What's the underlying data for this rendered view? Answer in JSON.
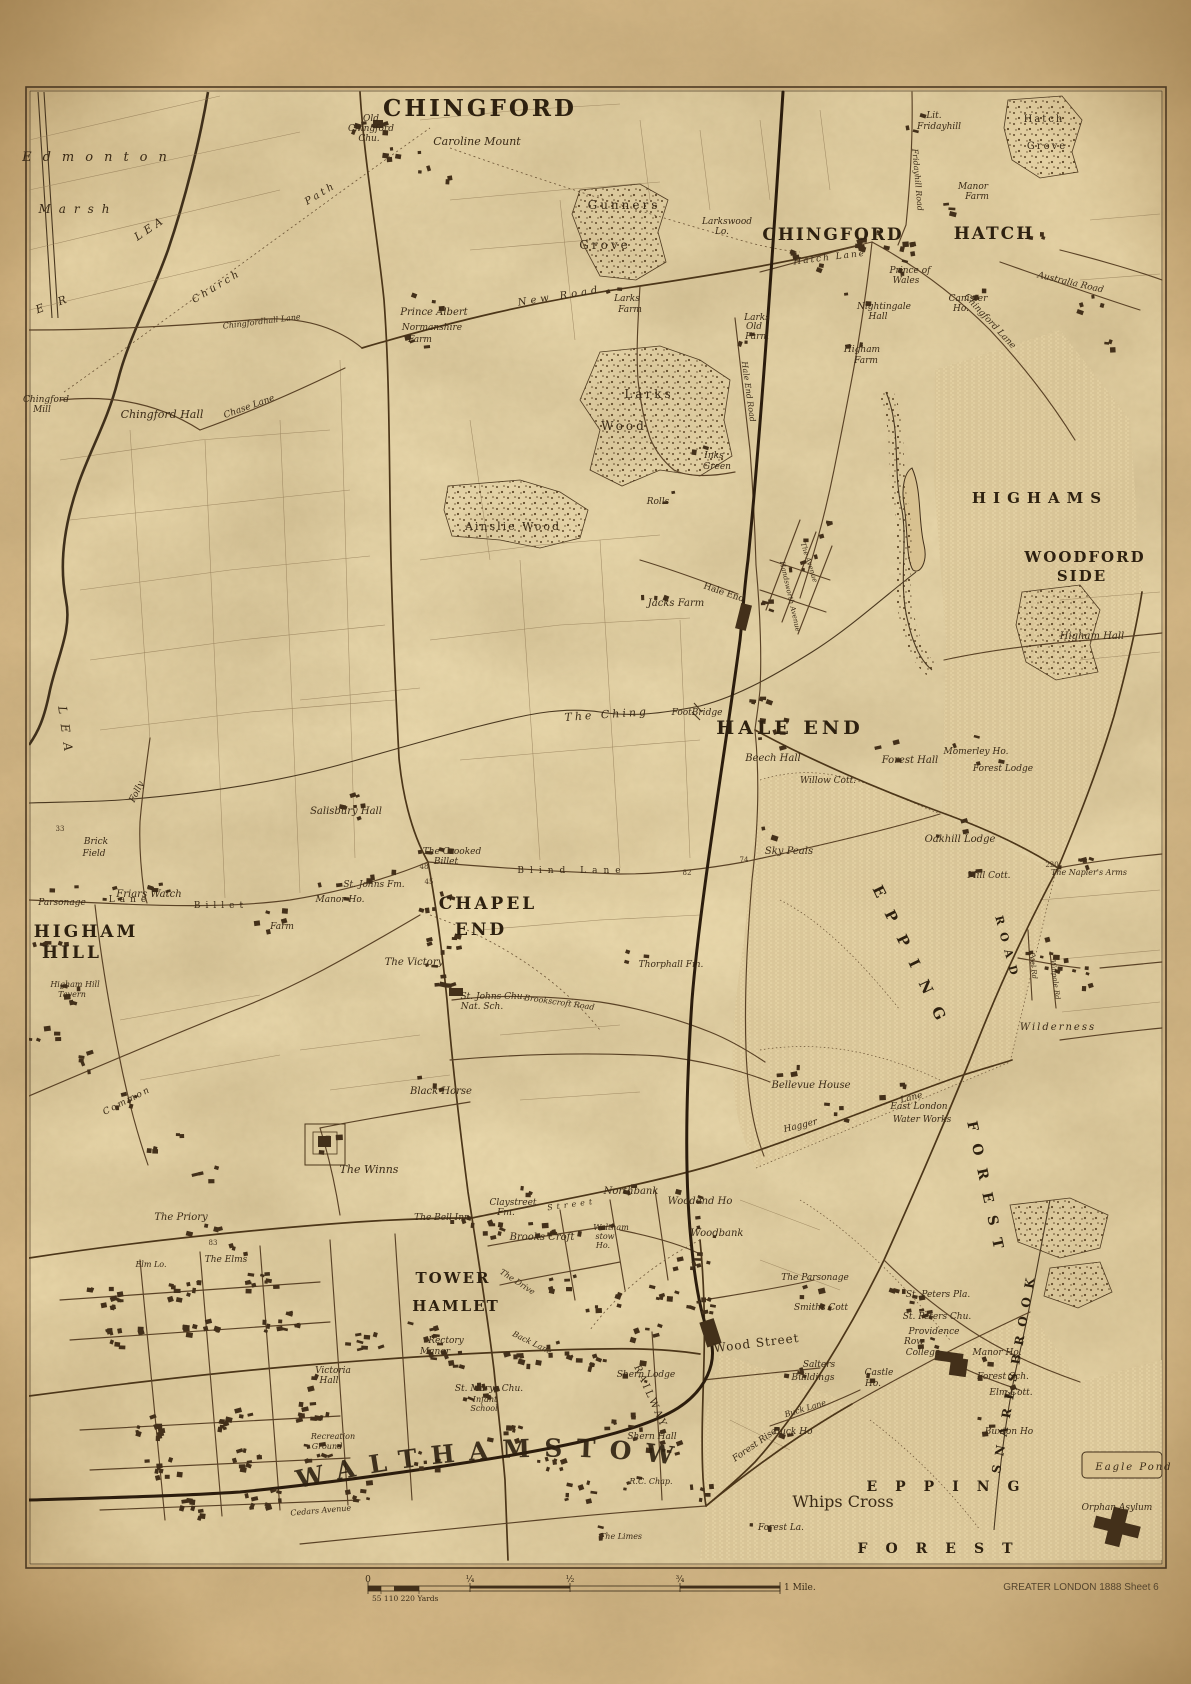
{
  "walthamstow": "WALTHAMSTOW",
  "attribution": "GREATER LONDON 1888   Sheet 6",
  "scalebar": {
    "zero": "0",
    "quarter": "¼",
    "half": "½",
    "threequarter": "¾",
    "mile": "1 Mile.",
    "yards": "55  110   220 Yards"
  },
  "labels": [
    {
      "t": "CHINGFORD",
      "x": 480,
      "y": 116,
      "s": 23,
      "cls": "d",
      "ls": 3
    },
    {
      "t": "CHINGFORD",
      "x": 833,
      "y": 240,
      "s": 17,
      "cls": "d",
      "ls": 2
    },
    {
      "t": "HATCH",
      "x": 994,
      "y": 239,
      "s": 17,
      "cls": "d",
      "ls": 2
    },
    {
      "t": "HIGHAMS",
      "x": 1040,
      "y": 503,
      "s": 15,
      "cls": "d",
      "ls": 7
    },
    {
      "t": "WOODFORD",
      "x": 1085,
      "y": 562,
      "s": 15,
      "cls": "d",
      "ls": 2
    },
    {
      "t": "SIDE",
      "x": 1082,
      "y": 581,
      "s": 15,
      "cls": "d",
      "ls": 2
    },
    {
      "t": "HALE END",
      "x": 790,
      "y": 734,
      "s": 19,
      "cls": "d",
      "ls": 4
    },
    {
      "t": "CHAPEL",
      "x": 488,
      "y": 909,
      "s": 17,
      "cls": "d",
      "ls": 3
    },
    {
      "t": "END",
      "x": 481,
      "y": 935,
      "s": 17,
      "cls": "d",
      "ls": 3
    },
    {
      "t": "HIGHAM",
      "x": 86,
      "y": 937,
      "s": 17,
      "cls": "d",
      "ls": 3
    },
    {
      "t": "HILL",
      "x": 72,
      "y": 958,
      "s": 17,
      "cls": "d",
      "ls": 3
    },
    {
      "t": "TOWER",
      "x": 453,
      "y": 1283,
      "s": 15,
      "cls": "d",
      "ls": 2
    },
    {
      "t": "HAMLET",
      "x": 456,
      "y": 1311,
      "s": 15,
      "cls": "d",
      "ls": 2
    },
    {
      "t": "EPPING",
      "x": 908,
      "y": 962,
      "s": 15,
      "cls": "d",
      "ls": 16,
      "rot": 64
    },
    {
      "t": "FOREST",
      "x": 982,
      "y": 1192,
      "s": 14,
      "cls": "d",
      "ls": 13,
      "rot": 78
    },
    {
      "t": "ROAD",
      "x": 1004,
      "y": 950,
      "s": 11,
      "cls": "d",
      "ls": 8,
      "rot": 75
    },
    {
      "t": "SNARESBROOK",
      "x": 1018,
      "y": 1372,
      "s": 12,
      "cls": "d",
      "ls": 9,
      "rot": -80
    },
    {
      "t": "EPPING",
      "x": 952,
      "y": 1491,
      "s": 14,
      "cls": "d",
      "ls": 18
    },
    {
      "t": "FOREST",
      "x": 944,
      "y": 1553,
      "s": 14,
      "cls": "d",
      "ls": 18
    },
    {
      "t": "Whips Cross",
      "x": 843,
      "y": 1507,
      "s": 16,
      "cls": "r"
    },
    {
      "t": "RAILWAY",
      "x": 648,
      "y": 1398,
      "s": 10,
      "cls": "r",
      "ls": 3,
      "rot": 66
    },
    {
      "t": "Old",
      "x": 371,
      "y": 121,
      "s": 9,
      "cls": "i"
    },
    {
      "t": "Chingford",
      "x": 371,
      "y": 131,
      "s": 9,
      "cls": "i"
    },
    {
      "t": "Chu.",
      "x": 369,
      "y": 141,
      "s": 9,
      "cls": "i"
    },
    {
      "t": "Caroline Mount",
      "x": 477,
      "y": 145,
      "s": 11,
      "cls": "i"
    },
    {
      "t": "Gunners",
      "x": 624,
      "y": 209,
      "s": 12,
      "cls": "r",
      "ls": 3
    },
    {
      "t": "Grove",
      "x": 605,
      "y": 249,
      "s": 12,
      "cls": "r",
      "ls": 3
    },
    {
      "t": "Larkswood",
      "x": 727,
      "y": 224,
      "s": 9,
      "cls": "i"
    },
    {
      "t": "Lo.",
      "x": 722,
      "y": 234,
      "s": 9,
      "cls": "i"
    },
    {
      "t": "Lit.",
      "x": 934,
      "y": 118,
      "s": 9,
      "cls": "i"
    },
    {
      "t": "Fridayhill",
      "x": 939,
      "y": 129,
      "s": 9,
      "cls": "i"
    },
    {
      "t": "Hatch",
      "x": 1044,
      "y": 122,
      "s": 10,
      "cls": "r",
      "ls": 2
    },
    {
      "t": "Grove",
      "x": 1047,
      "y": 149,
      "s": 10,
      "cls": "r",
      "ls": 2
    },
    {
      "t": "Manor",
      "x": 973,
      "y": 189,
      "s": 9,
      "cls": "i"
    },
    {
      "t": "Farm",
      "x": 977,
      "y": 199,
      "s": 9,
      "cls": "i"
    },
    {
      "t": "Prince Albert",
      "x": 434,
      "y": 315,
      "s": 10,
      "cls": "i"
    },
    {
      "t": "Normanshire",
      "x": 432,
      "y": 330,
      "s": 9,
      "cls": "i"
    },
    {
      "t": "Farm",
      "x": 420,
      "y": 342,
      "s": 9,
      "cls": "i"
    },
    {
      "t": "Larks",
      "x": 627,
      "y": 301,
      "s": 9,
      "cls": "i"
    },
    {
      "t": "Farm",
      "x": 630,
      "y": 312,
      "s": 9,
      "cls": "i"
    },
    {
      "t": "Prince of",
      "x": 910,
      "y": 273,
      "s": 9,
      "cls": "i"
    },
    {
      "t": "Wales",
      "x": 906,
      "y": 283,
      "s": 9,
      "cls": "i"
    },
    {
      "t": "Nightingale",
      "x": 884,
      "y": 309,
      "s": 9,
      "cls": "i"
    },
    {
      "t": "Hall",
      "x": 878,
      "y": 319,
      "s": 9,
      "cls": "i"
    },
    {
      "t": "Canister",
      "x": 968,
      "y": 301,
      "s": 9,
      "cls": "i"
    },
    {
      "t": "Ho.",
      "x": 961,
      "y": 311,
      "s": 9,
      "cls": "i"
    },
    {
      "t": "Larks",
      "x": 757,
      "y": 320,
      "s": 9,
      "cls": "i"
    },
    {
      "t": "Old",
      "x": 754,
      "y": 329,
      "s": 9,
      "cls": "i"
    },
    {
      "t": "Farm",
      "x": 757,
      "y": 339,
      "s": 9,
      "cls": "i"
    },
    {
      "t": "Higham",
      "x": 862,
      "y": 352,
      "s": 9,
      "cls": "i"
    },
    {
      "t": "Farm",
      "x": 866,
      "y": 363,
      "s": 9,
      "cls": "i"
    },
    {
      "t": "Chingford",
      "x": 46,
      "y": 402,
      "s": 9,
      "cls": "i"
    },
    {
      "t": "Mill",
      "x": 42,
      "y": 412,
      "s": 9,
      "cls": "i"
    },
    {
      "t": "Chingford Hall",
      "x": 162,
      "y": 418,
      "s": 11,
      "cls": "i"
    },
    {
      "t": "Chase Lane",
      "x": 250,
      "y": 409,
      "s": 9,
      "cls": "i",
      "rot": -20
    },
    {
      "t": "Church",
      "x": 218,
      "y": 289,
      "s": 10,
      "cls": "i",
      "rot": -31,
      "ls": 3
    },
    {
      "t": "Path",
      "x": 322,
      "y": 196,
      "s": 10,
      "cls": "i",
      "rot": -31,
      "ls": 3
    },
    {
      "t": "Chingfordhall Lane",
      "x": 262,
      "y": 324,
      "s": 8,
      "cls": "i",
      "rot": -7
    },
    {
      "t": "Edmonton",
      "x": 100,
      "y": 161,
      "s": 13,
      "cls": "i",
      "ls": 11
    },
    {
      "t": "Marsh",
      "x": 78,
      "y": 213,
      "s": 12,
      "cls": "i",
      "ls": 8
    },
    {
      "t": "E R",
      "x": 55,
      "y": 307,
      "s": 11,
      "cls": "i",
      "ls": 6,
      "rot": -20
    },
    {
      "t": "LEA",
      "x": 152,
      "y": 231,
      "s": 11,
      "cls": "i",
      "ls": 4,
      "rot": -34
    },
    {
      "t": "LEA",
      "x": 62,
      "y": 734,
      "s": 12,
      "cls": "i",
      "ls": 10,
      "rot": 82
    },
    {
      "t": "Larks",
      "x": 649,
      "y": 398,
      "s": 12,
      "cls": "r",
      "ls": 3
    },
    {
      "t": "Wood",
      "x": 624,
      "y": 430,
      "s": 12,
      "cls": "r",
      "ls": 3
    },
    {
      "t": "Ainslie Wood",
      "x": 513,
      "y": 530,
      "s": 11,
      "cls": "r",
      "ls": 2
    },
    {
      "t": "Inks",
      "x": 714,
      "y": 458,
      "s": 9,
      "cls": "i"
    },
    {
      "t": "Green",
      "x": 717,
      "y": 469,
      "s": 9,
      "cls": "i"
    },
    {
      "t": "Rolls",
      "x": 658,
      "y": 504,
      "s": 9,
      "cls": "i"
    },
    {
      "t": "Hale End Road",
      "x": 746,
      "y": 392,
      "s": 8,
      "cls": "i",
      "rot": 82
    },
    {
      "t": "Fridayhill Road",
      "x": 915,
      "y": 180,
      "s": 8,
      "cls": "i",
      "rot": 85
    },
    {
      "t": "Hatch Lane",
      "x": 830,
      "y": 260,
      "s": 9,
      "cls": "i",
      "rot": -7,
      "ls": 2
    },
    {
      "t": "Australia Road",
      "x": 1070,
      "y": 285,
      "s": 9,
      "cls": "i",
      "rot": 13
    },
    {
      "t": "Chingford Lane",
      "x": 988,
      "y": 323,
      "s": 9,
      "cls": "i",
      "rot": 47
    },
    {
      "t": "New Road",
      "x": 560,
      "y": 299,
      "s": 10,
      "cls": "i",
      "rot": -9,
      "ls": 4
    },
    {
      "t": "Jacks Farm",
      "x": 676,
      "y": 606,
      "s": 10,
      "cls": "i"
    },
    {
      "t": "Hale End",
      "x": 723,
      "y": 595,
      "s": 9,
      "cls": "r",
      "rot": 19
    },
    {
      "t": "The Ching",
      "x": 607,
      "y": 718,
      "s": 11,
      "cls": "i",
      "ls": 3,
      "rot": -4
    },
    {
      "t": "FootBridge",
      "x": 697,
      "y": 715,
      "s": 9,
      "cls": "i"
    },
    {
      "t": "Beech Hall",
      "x": 773,
      "y": 761,
      "s": 10,
      "cls": "i"
    },
    {
      "t": "Willow Cott.",
      "x": 828,
      "y": 783,
      "s": 9,
      "cls": "i"
    },
    {
      "t": "Forest Hall",
      "x": 910,
      "y": 763,
      "s": 10,
      "cls": "i"
    },
    {
      "t": "Momerley Ho.",
      "x": 976,
      "y": 754,
      "s": 9,
      "cls": "i"
    },
    {
      "t": "Forest Lodge",
      "x": 1003,
      "y": 771,
      "s": 9,
      "cls": "i"
    },
    {
      "t": "Higham Hall",
      "x": 1092,
      "y": 639,
      "s": 10,
      "cls": "i"
    },
    {
      "t": "Salisbury Hall",
      "x": 346,
      "y": 814,
      "s": 10,
      "cls": "i"
    },
    {
      "t": "The Crooked",
      "x": 452,
      "y": 854,
      "s": 9,
      "cls": "i"
    },
    {
      "t": "Billet",
      "x": 446,
      "y": 864,
      "s": 9,
      "cls": "i"
    },
    {
      "t": "St. Johns Fm.",
      "x": 374,
      "y": 887,
      "s": 9,
      "cls": "i"
    },
    {
      "t": "Manor Ho.",
      "x": 340,
      "y": 902,
      "s": 9,
      "cls": "i"
    },
    {
      "t": "Farm",
      "x": 282,
      "y": 929,
      "s": 9,
      "cls": "i"
    },
    {
      "t": "Brick",
      "x": 96,
      "y": 844,
      "s": 9,
      "cls": "i"
    },
    {
      "t": "Field",
      "x": 94,
      "y": 856,
      "s": 9,
      "cls": "i"
    },
    {
      "t": "Friars Watch",
      "x": 149,
      "y": 897,
      "s": 10,
      "cls": "i"
    },
    {
      "t": "Parsonage",
      "x": 62,
      "y": 905,
      "s": 9,
      "cls": "i"
    },
    {
      "t": "Billet",
      "x": 221,
      "y": 908,
      "s": 9,
      "cls": "r",
      "ls": 5
    },
    {
      "t": "Lane",
      "x": 130,
      "y": 902,
      "s": 9,
      "cls": "r",
      "ls": 5
    },
    {
      "t": "Folly",
      "x": 139,
      "y": 793,
      "s": 9,
      "cls": "i",
      "rot": -64
    },
    {
      "t": "Blind Lane",
      "x": 572,
      "y": 873,
      "s": 9,
      "cls": "r",
      "ls": 6
    },
    {
      "t": "Sky Peals",
      "x": 789,
      "y": 854,
      "s": 10,
      "cls": "i"
    },
    {
      "t": "Oakhill Lodge",
      "x": 960,
      "y": 842,
      "s": 10,
      "cls": "i"
    },
    {
      "t": "Mill Cott.",
      "x": 989,
      "y": 878,
      "s": 9,
      "cls": "i"
    },
    {
      "t": "The Napier's Arms",
      "x": 1089,
      "y": 875,
      "s": 8,
      "cls": "i"
    },
    {
      "t": "Wilderness",
      "x": 1058,
      "y": 1030,
      "s": 10,
      "cls": "i",
      "ls": 2
    },
    {
      "t": "Peel Rd",
      "x": 1031,
      "y": 966,
      "s": 7,
      "cls": "i",
      "rot": 83
    },
    {
      "t": "Walpole Rd",
      "x": 1053,
      "y": 980,
      "s": 7,
      "cls": "i",
      "rot": 83
    },
    {
      "t": "Thorphall Fm.",
      "x": 671,
      "y": 967,
      "s": 9,
      "cls": "i"
    },
    {
      "t": "The Victory",
      "x": 414,
      "y": 965,
      "s": 10,
      "cls": "i"
    },
    {
      "t": "St. Johns Chu.",
      "x": 493,
      "y": 999,
      "s": 9,
      "cls": "i"
    },
    {
      "t": "Nat. Sch.",
      "x": 482,
      "y": 1009,
      "s": 9,
      "cls": "i"
    },
    {
      "t": "Brookscroft Road",
      "x": 559,
      "y": 1005,
      "s": 8,
      "cls": "i",
      "rot": 8
    },
    {
      "t": "Black Horse",
      "x": 441,
      "y": 1094,
      "s": 10,
      "cls": "i"
    },
    {
      "t": "The Winns",
      "x": 369,
      "y": 1173,
      "s": 11,
      "cls": "i"
    },
    {
      "t": "The Priory",
      "x": 181,
      "y": 1220,
      "s": 10,
      "cls": "i"
    },
    {
      "t": "The Elms",
      "x": 226,
      "y": 1262,
      "s": 9,
      "cls": "i"
    },
    {
      "t": "Elm Lo.",
      "x": 151,
      "y": 1267,
      "s": 8,
      "cls": "i"
    },
    {
      "t": "The Bell Inn",
      "x": 442,
      "y": 1220,
      "s": 9,
      "cls": "i"
    },
    {
      "t": "Common",
      "x": 128,
      "y": 1103,
      "s": 9,
      "cls": "i",
      "rot": -27,
      "ls": 2
    },
    {
      "t": "Claystreet",
      "x": 513,
      "y": 1205,
      "s": 9,
      "cls": "i"
    },
    {
      "t": "Fm.",
      "x": 506,
      "y": 1215,
      "s": 9,
      "cls": "i"
    },
    {
      "t": "Street",
      "x": 572,
      "y": 1207,
      "s": 8,
      "cls": "i",
      "rot": -8,
      "ls": 4
    },
    {
      "t": "Brooks Croft",
      "x": 542,
      "y": 1240,
      "s": 10,
      "cls": "i"
    },
    {
      "t": "Northbank",
      "x": 631,
      "y": 1194,
      "s": 10,
      "cls": "i"
    },
    {
      "t": "Woodend Ho",
      "x": 700,
      "y": 1204,
      "s": 10,
      "cls": "i"
    },
    {
      "t": "Woodbank",
      "x": 717,
      "y": 1236,
      "s": 10,
      "cls": "i"
    },
    {
      "t": "Waltham",
      "x": 611,
      "y": 1230,
      "s": 8,
      "cls": "i"
    },
    {
      "t": "stow",
      "x": 605,
      "y": 1239,
      "s": 8,
      "cls": "i"
    },
    {
      "t": "Ho.",
      "x": 603,
      "y": 1248,
      "s": 8,
      "cls": "i"
    },
    {
      "t": "The Drive",
      "x": 516,
      "y": 1284,
      "s": 8,
      "cls": "i",
      "rot": 33
    },
    {
      "t": "Hagger",
      "x": 801,
      "y": 1128,
      "s": 9,
      "cls": "i",
      "rot": -14
    },
    {
      "t": "Lane",
      "x": 912,
      "y": 1100,
      "s": 9,
      "cls": "i",
      "rot": -14
    },
    {
      "t": "East London",
      "x": 919,
      "y": 1109,
      "s": 9,
      "cls": "i"
    },
    {
      "t": "Water Works",
      "x": 922,
      "y": 1122,
      "s": 9,
      "cls": "i"
    },
    {
      "t": "Bellevue House",
      "x": 811,
      "y": 1088,
      "s": 10,
      "cls": "i"
    },
    {
      "t": "74",
      "x": 744,
      "y": 862,
      "s": 7,
      "cls": "n"
    },
    {
      "t": "82",
      "x": 687,
      "y": 875,
      "s": 7,
      "cls": "n"
    },
    {
      "t": "48",
      "x": 424,
      "y": 869,
      "s": 7,
      "cls": "n"
    },
    {
      "t": "45",
      "x": 429,
      "y": 884,
      "s": 7,
      "cls": "n"
    },
    {
      "t": "33",
      "x": 60,
      "y": 831,
      "s": 7,
      "cls": "n"
    },
    {
      "t": "220",
      "x": 1052,
      "y": 867,
      "s": 7,
      "cls": "n"
    },
    {
      "t": "83",
      "x": 213,
      "y": 1245,
      "s": 7,
      "cls": "n"
    },
    {
      "t": "Rectory",
      "x": 446,
      "y": 1343,
      "s": 9,
      "cls": "i"
    },
    {
      "t": "Manor",
      "x": 435,
      "y": 1354,
      "s": 9,
      "cls": "i"
    },
    {
      "t": "Victoria",
      "x": 333,
      "y": 1373,
      "s": 9,
      "cls": "i"
    },
    {
      "t": "Hall",
      "x": 329,
      "y": 1383,
      "s": 9,
      "cls": "i"
    },
    {
      "t": "St. Marys Chu.",
      "x": 489,
      "y": 1391,
      "s": 9,
      "cls": "i"
    },
    {
      "t": "Infant",
      "x": 485,
      "y": 1402,
      "s": 8,
      "cls": "i"
    },
    {
      "t": "School",
      "x": 484,
      "y": 1411,
      "s": 8,
      "cls": "i"
    },
    {
      "t": "Recreation",
      "x": 333,
      "y": 1439,
      "s": 8,
      "cls": "i"
    },
    {
      "t": "Ground",
      "x": 327,
      "y": 1449,
      "s": 8,
      "cls": "i"
    },
    {
      "t": "Back Lane",
      "x": 531,
      "y": 1345,
      "s": 8,
      "cls": "i",
      "rot": 26
    },
    {
      "t": "Shern Lodge",
      "x": 646,
      "y": 1377,
      "s": 9,
      "cls": "i"
    },
    {
      "t": "Shern Hall",
      "x": 652,
      "y": 1439,
      "s": 9,
      "cls": "i"
    },
    {
      "t": "R.C. Chap.",
      "x": 651,
      "y": 1484,
      "s": 8,
      "cls": "i"
    },
    {
      "t": "The Limes",
      "x": 621,
      "y": 1539,
      "s": 8,
      "cls": "i"
    },
    {
      "t": "Cedars Avenue",
      "x": 321,
      "y": 1513,
      "s": 8,
      "cls": "i",
      "rot": -5
    },
    {
      "t": "Wood Street",
      "x": 757,
      "y": 1347,
      "s": 12,
      "cls": "r",
      "rot": -7,
      "ls": 1
    },
    {
      "t": "The Parsonage",
      "x": 815,
      "y": 1280,
      "s": 9,
      "cls": "i"
    },
    {
      "t": "Smiths Cott",
      "x": 821,
      "y": 1310,
      "s": 9,
      "cls": "i"
    },
    {
      "t": "St. Peters Pla.",
      "x": 938,
      "y": 1297,
      "s": 9,
      "cls": "i"
    },
    {
      "t": "St. Peters Chu.",
      "x": 937,
      "y": 1319,
      "s": 9,
      "cls": "i"
    },
    {
      "t": "Providence",
      "x": 934,
      "y": 1334,
      "s": 9,
      "cls": "i"
    },
    {
      "t": "Row",
      "x": 914,
      "y": 1344,
      "s": 9,
      "cls": "i"
    },
    {
      "t": "College",
      "x": 923,
      "y": 1355,
      "s": 9,
      "cls": "i"
    },
    {
      "t": "Manor Ho.",
      "x": 997,
      "y": 1355,
      "s": 9,
      "cls": "i"
    },
    {
      "t": "Forest Sch.",
      "x": 1003,
      "y": 1379,
      "s": 9,
      "cls": "i"
    },
    {
      "t": "Elm Cott.",
      "x": 1011,
      "y": 1395,
      "s": 9,
      "cls": "i"
    },
    {
      "t": "Buxton Ho",
      "x": 1009,
      "y": 1434,
      "s": 9,
      "cls": "i"
    },
    {
      "t": "Castle",
      "x": 879,
      "y": 1375,
      "s": 9,
      "cls": "i"
    },
    {
      "t": "Ho.",
      "x": 873,
      "y": 1386,
      "s": 9,
      "cls": "i"
    },
    {
      "t": "Salters",
      "x": 819,
      "y": 1367,
      "s": 9,
      "cls": "i"
    },
    {
      "t": "Buildings",
      "x": 813,
      "y": 1380,
      "s": 9,
      "cls": "i"
    },
    {
      "t": "Buck Ho",
      "x": 793,
      "y": 1434,
      "s": 9,
      "cls": "i"
    },
    {
      "t": "Buck Lane",
      "x": 806,
      "y": 1411,
      "s": 8,
      "cls": "i",
      "rot": -17
    },
    {
      "t": "Forest Rise",
      "x": 756,
      "y": 1447,
      "s": 9,
      "cls": "i",
      "rot": -35
    },
    {
      "t": "Forest La.",
      "x": 781,
      "y": 1530,
      "s": 9,
      "cls": "i"
    },
    {
      "t": "Eagle Pond",
      "x": 1134,
      "y": 1470,
      "s": 10,
      "cls": "i",
      "ls": 2
    },
    {
      "t": "Orphan Asylum",
      "x": 1117,
      "y": 1510,
      "s": 9,
      "cls": "i"
    },
    {
      "t": "Higham Hill",
      "x": 75,
      "y": 987,
      "s": 8,
      "cls": "i"
    },
    {
      "t": "Tavern",
      "x": 72,
      "y": 997,
      "s": 8,
      "cls": "i"
    },
    {
      "t": "The Avenue",
      "x": 807,
      "y": 563,
      "s": 7,
      "cls": "i",
      "rot": 72
    },
    {
      "t": "Handsworth Avenue",
      "x": 788,
      "y": 597,
      "s": 7,
      "cls": "i",
      "rot": 77
    }
  ]
}
